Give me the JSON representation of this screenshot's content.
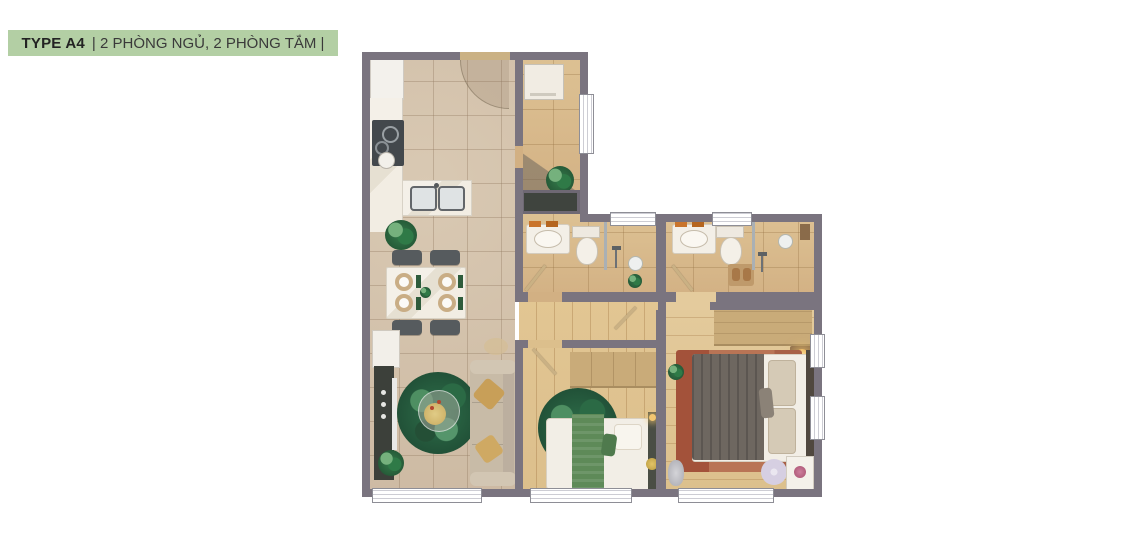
{
  "header": {
    "type_label": "TYPE A4",
    "subtitle": "| 2 PHÒNG NGỦ, 2 PHÒNG TẮM |"
  },
  "colors": {
    "header_bg": "#b3cfa4",
    "header_text": "#232323",
    "wall": "#7a747f",
    "window_frame": "#8e8e96",
    "tile_floor": "#cdbaa3",
    "bath_floor": "#d2b083",
    "wood_floor": "#dcbf8c",
    "wood_floor_2": "#e4cb9d",
    "rug_green_dark": "#1c4530",
    "rug_terracotta": "#b97455",
    "rug_terracotta_dark": "#a3523a",
    "sofa": "#c8bba7",
    "bed_linen": "#f2eee6",
    "duvet_dark": "#6e6760",
    "green_textile": "#5e8a58",
    "furniture_wood": "#c9ab79",
    "dark_unit": "#3c403a",
    "door_leaf": "#cab184",
    "towel_orange": "#c9742c",
    "lamp_glow": "#f2c671",
    "pouf": "#d6cfe2"
  },
  "plan": {
    "rooms": [
      {
        "name": "kitchen",
        "furniture": [
          "fridge",
          "marble-counter",
          "stove-cooktop",
          "island-double-sink"
        ]
      },
      {
        "name": "dining",
        "furniture": [
          "dining-table",
          "four-chairs",
          "potted-plant",
          "sideboard"
        ]
      },
      {
        "name": "living",
        "furniture": [
          "tv-console",
          "sofa",
          "round-green-rug",
          "coffee-table",
          "potted-plant"
        ]
      },
      {
        "name": "entry",
        "furniture": [
          "entrance-door"
        ]
      },
      {
        "name": "laundry",
        "furniture": [
          "washing-machine",
          "potted-plant"
        ]
      },
      {
        "name": "shaft",
        "furniture": []
      },
      {
        "name": "bathroom-1",
        "furniture": [
          "vanity-sink",
          "toilet",
          "shower",
          "glass-divider"
        ]
      },
      {
        "name": "bathroom-2",
        "furniture": [
          "vanity-sink",
          "toilet",
          "shower",
          "glass-divider",
          "bath-mat"
        ]
      },
      {
        "name": "hallway",
        "furniture": []
      },
      {
        "name": "bedroom-1",
        "furniture": [
          "wardrobe",
          "single-bed",
          "round-green-rug",
          "headboard-console"
        ]
      },
      {
        "name": "bedroom-2",
        "furniture": [
          "wardrobe",
          "double-bed",
          "terracotta-rug",
          "nightstand-lamp",
          "pouf",
          "desk-flowers",
          "sculpture"
        ]
      }
    ]
  }
}
